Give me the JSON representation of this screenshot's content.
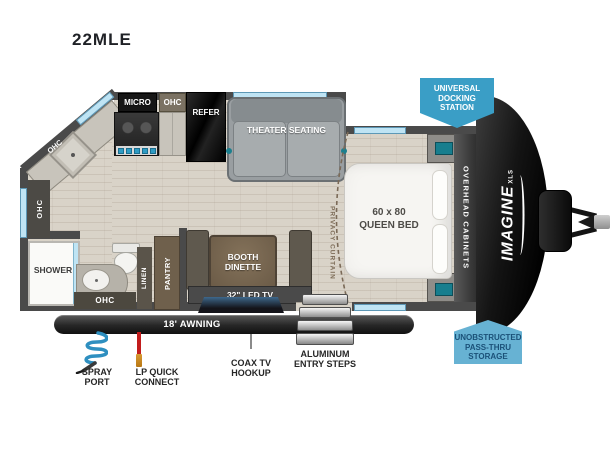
{
  "title": "22MLE",
  "brand": {
    "name": "IMAGINE",
    "sub": "XLS"
  },
  "badges": {
    "docking": {
      "line1": "UNIVERSAL",
      "line2": "DOCKING",
      "line3": "STATION"
    },
    "storage": {
      "line1": "UNOBSTRUCTED",
      "line2": "PASS-THRU",
      "line3": "STORAGE"
    }
  },
  "labels": {
    "micro": "MICRO",
    "ohc_kitchen": "OHC",
    "refer": "REFER",
    "theater": "THEATER SEATING",
    "ohc_corner": "OHC",
    "ohc_left": "OHC",
    "shower": "SHOWER",
    "ohc_bath": "OHC",
    "linen": "LINEN",
    "pantry": "PANTRY",
    "booth1": "BOOTH",
    "booth2": "DINETTE",
    "tv": "32\" LED TV",
    "bed1": "60 x 80",
    "bed2": "QUEEN BED",
    "overhead": "OVERHEAD CABINETS",
    "privacy": "PRIVACY CURTAIN",
    "awning": "18' AWNING"
  },
  "callouts": {
    "spray1": "SPRAY",
    "spray2": "PORT",
    "lp1": "LP QUICK",
    "lp2": "CONNECT",
    "coax1": "COAX TV",
    "coax2": "HOOKUP",
    "steps1": "ALUMINUM",
    "steps2": "ENTRY STEPS"
  },
  "colors": {
    "badge_docking_bg": "#3a9ec6",
    "badge_storage_bg": "#67b2d3",
    "badge_storage_text": "#1b5178",
    "window_blue": "#bfe4f4",
    "wall_gray": "#4a4a4a",
    "floor_wood": "#d9d3c8",
    "awning_bar": "#262626",
    "spray_hose_blue": "#2e8fc0",
    "lp_line_red": "#c21d1d",
    "accent_teal": "#1b7f8e",
    "table_wood_brown": "#6f604c"
  }
}
